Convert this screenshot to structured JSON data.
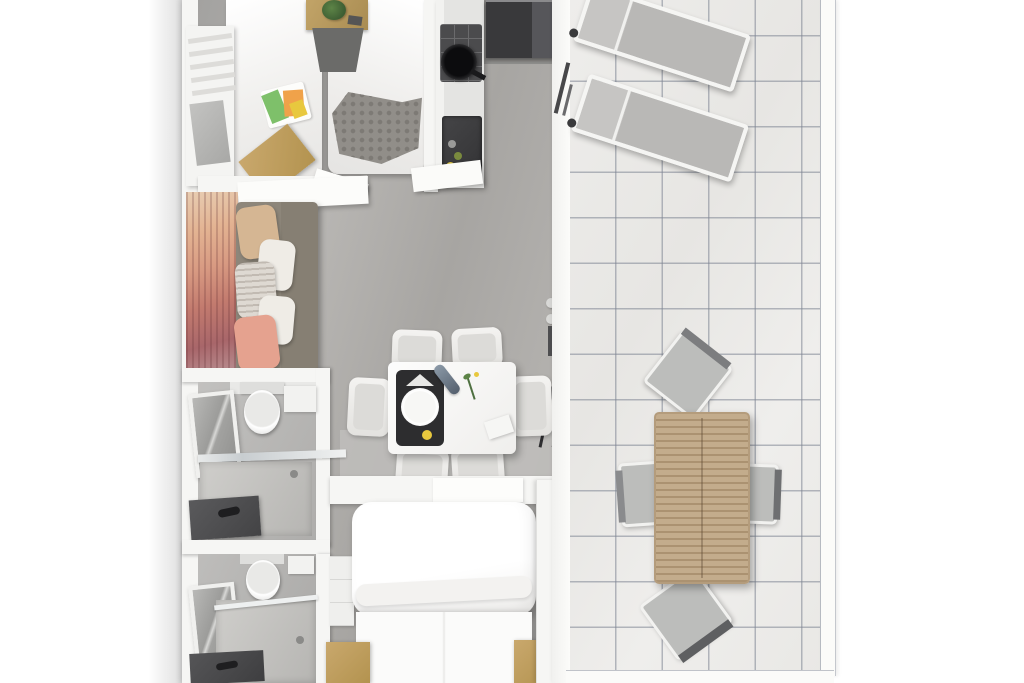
{
  "scene": {
    "type": "3d-floorplan-top-view",
    "description": "Photorealistic top-down 3D rendering of a mobile-home floor plan with an attached tiled terrace; no text is rendered in the image",
    "rooms": [
      {
        "id": "twin-bedroom",
        "furniture": [
          "single-bed-left",
          "single-bed-right",
          "nightstand-with-plant",
          "wardrobe-shelves",
          "gray-knit-blanket",
          "wooden-foot-bench",
          "dark-rug"
        ]
      },
      {
        "id": "kitchen",
        "furniture": [
          "counter",
          "gas-hob-with-pan",
          "sink-with-bottles",
          "dark-fridge"
        ]
      },
      {
        "id": "living-room",
        "furniture": [
          "sunset-mural-wall",
          "gray-sofa",
          "pillows-beige-white-striped-pink",
          "wall-table",
          "open-door-panel"
        ]
      },
      {
        "id": "dining-area",
        "furniture": [
          "white-table",
          "six-white-chairs",
          "black-placemat-with-plate",
          "bottle",
          "flower-sprig",
          "card",
          "floor-lamp"
        ]
      },
      {
        "id": "bathroom-top",
        "furniture": [
          "toilet",
          "mirror",
          "shower-tray-with-glass",
          "dark-vanity-sink",
          "shelf"
        ]
      },
      {
        "id": "bathroom-bottom",
        "furniture": [
          "toilet",
          "mirror",
          "shower-tray",
          "dark-vanity-corner",
          "shelf"
        ]
      },
      {
        "id": "master-bedroom",
        "furniture": [
          "double-bed-white-duvet",
          "wooden-side-benches",
          "side-shelf-unit",
          "headboard-shelf",
          "white-rug"
        ]
      },
      {
        "id": "terrace",
        "furniture": [
          "sun-lounger-1",
          "sun-lounger-2",
          "wooden-slatted-table",
          "outdoor-chair-top",
          "outdoor-chair-left",
          "outdoor-chair-right",
          "outdoor-chair-bottom"
        ]
      }
    ]
  },
  "palette": {
    "background": "#ffffff",
    "wall": "#f6f6f4",
    "floor": "#aeacaa",
    "floor_light": "#c0bfbd",
    "tile": "#ecebe9",
    "tile_line": "#8d95a5",
    "wood": "#c9a86d",
    "outdoor_wood": "#c3ac8c",
    "appliance_dark": "#39393b",
    "sofa": "#867f73",
    "pillow_beige": "#d5b693",
    "pillow_pink": "#e5a28f",
    "blanket_gray": "#918e89",
    "lounger_fabric": "#b9b8b6",
    "plant_green": "#3e5e33",
    "placemat_black": "#2d2d2f",
    "chip_yellow": "#e8c83e"
  }
}
